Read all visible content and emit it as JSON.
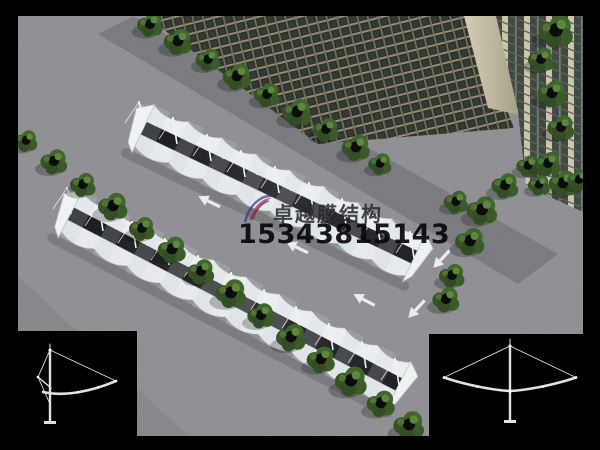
{
  "image": {
    "kind": "architectural-rendering-photo",
    "subject": "aerial view of two rows of white tensile membrane carports in a parking lot beside a high-rise building, with rows of round green trees",
    "background_color": "#000000"
  },
  "watermark": {
    "logo_icon": "zhuoyue-membrane-logo",
    "brand_text": "卓越膜结构",
    "phone_number": "15343815143",
    "brand_text_color": "#26262a",
    "phone_color": "#0a0a0c",
    "logo_blue": "#1d3a8f",
    "logo_red": "#c1272d"
  },
  "scene_palette": {
    "asphalt": "#8e8e92",
    "canopy_membrane": "#edf1f3",
    "canopy_shadow_strip": "#1b1c20",
    "tree_green": "#3a5f24",
    "building_window": "#23271f",
    "building_mullion": "#8f8a74",
    "building_pilaster": "#cdc6ac",
    "pavement_arrow": "#eef0f1"
  },
  "diagrams": {
    "left": {
      "name": "single-cantilever-carport-frame-elevation",
      "line_color": "#dfe1e2",
      "background": "#000000"
    },
    "right": {
      "name": "double-cantilever-carport-frame-elevation",
      "line_color": "#dfe1e2",
      "background": "#000000"
    }
  }
}
